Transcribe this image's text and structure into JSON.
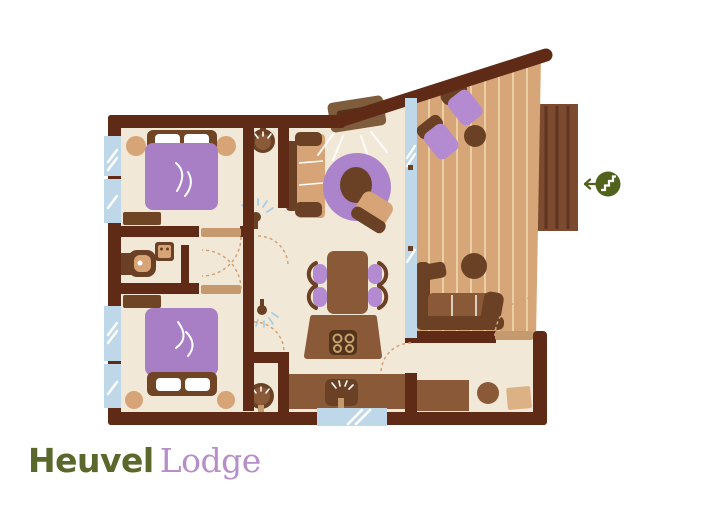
{
  "logo": {
    "name": "Heuvel",
    "type": "Lodge"
  },
  "colors": {
    "wall": "#5f2b17",
    "floor": "#f2e8d7",
    "deck": "#d7a678",
    "deck_plank": "#eacfa5",
    "window": "#bed8e9",
    "purple_bed": "#a87fc5",
    "purple_rug": "#ab84cc",
    "purple_chair": "#b48bd1",
    "brown_dark": "#6b4126",
    "brown_mid": "#8a5a38",
    "brown_head": "#6f4526",
    "tv_brown": "#7f5c3b",
    "tan": "#d6a476",
    "tan_light": "#dcb185",
    "door_leaf": "#c49a6e",
    "dash": "#d3a376",
    "stove": "#53331a",
    "platform": "#7c4a2f",
    "platform_line": "#603420",
    "green": "#51621d",
    "logo_green": "#5a682c",
    "logo_purple": "#b68fc8",
    "light_ray": "#a9cde6",
    "white": "#ffffff"
  },
  "icons": {
    "stairs_entrance": "stairs-entrance-icon",
    "arrow": "left-arrow-icon",
    "shower_light": "ceiling-light-icon",
    "washbasin": "washbasin-icon",
    "toilet": "toilet-icon",
    "sink": "kitchen-sink-icon",
    "stove": "stove-burners-icon"
  }
}
